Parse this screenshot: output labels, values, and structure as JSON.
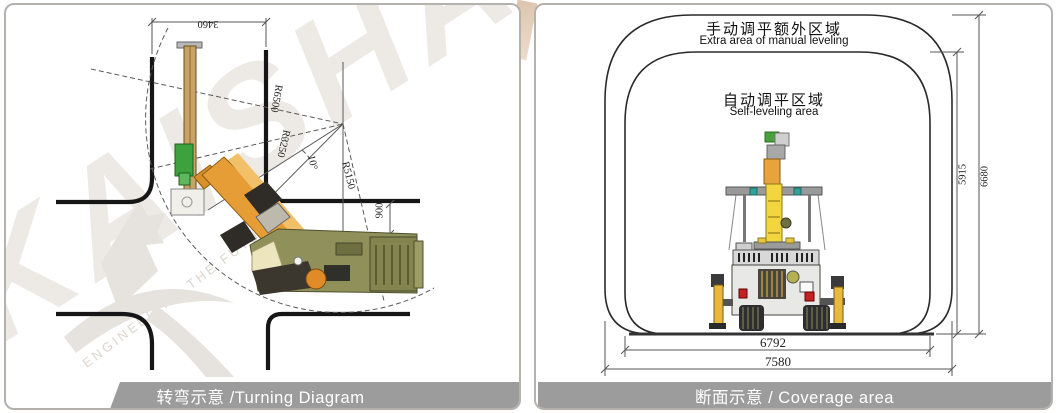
{
  "watermark": {
    "brand": "KAISHAN",
    "tagline": "ENGINEERING THE FUTURE"
  },
  "left_panel": {
    "caption": "转弯示意 /Turning Diagram",
    "dimensions": {
      "road_width": "3460",
      "outer_radius": "R6500",
      "inner_radius": "R3250",
      "mid_radius": "R5150",
      "swing_angle": "10°",
      "edge_clearance": "900"
    }
  },
  "right_panel": {
    "caption": "断面示意 / Coverage area",
    "outer_area_zh": "手动调平额外区域",
    "outer_area_en": "Extra area of manual leveling",
    "inner_area_zh": "自动调平区域",
    "inner_area_en": "Self-leveling area",
    "dimensions": {
      "inner_height": "5915",
      "outer_height": "6680",
      "inner_width": "6792",
      "outer_width": "7580"
    }
  },
  "colors": {
    "caption_bar": "#9c9c9c",
    "body_olive": "#90915a",
    "boom_orange": "#e69d35",
    "mast_yellow": "#f2d53f",
    "carriage_green": "#3da23d",
    "page_wedge_beige": "#dcc5ae",
    "watermark_gray": "#edeae6"
  }
}
